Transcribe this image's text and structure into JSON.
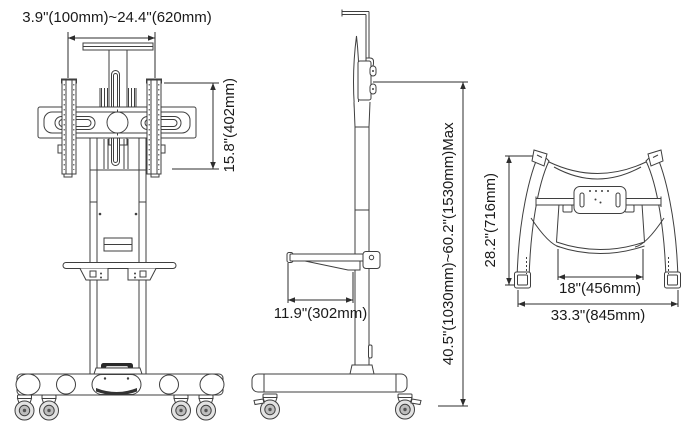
{
  "drawing": {
    "front_view": {
      "mount_width_label": "3.9\"(100mm)~24.4\"(620mm)",
      "bracket_height_label": "15.8\"(402mm)"
    },
    "side_view": {
      "shelf_depth_label": "11.9\"(302mm)",
      "height_range_label": "40.5\"(1030mm)~60.2\"(1530mm)Max"
    },
    "rear_view": {
      "depth_label": "28.2\"(716mm)",
      "tray_width_label": "18\"(456mm)",
      "width_label": "33.3\"(845mm)"
    }
  },
  "colors": {
    "line": "#3f3f3f",
    "dimension_line": "#2d2d2d",
    "text": "#1a1a1a",
    "background": "#ffffff",
    "wheel_shade": "#e3e3e3",
    "badge": "#2a2a2a"
  }
}
